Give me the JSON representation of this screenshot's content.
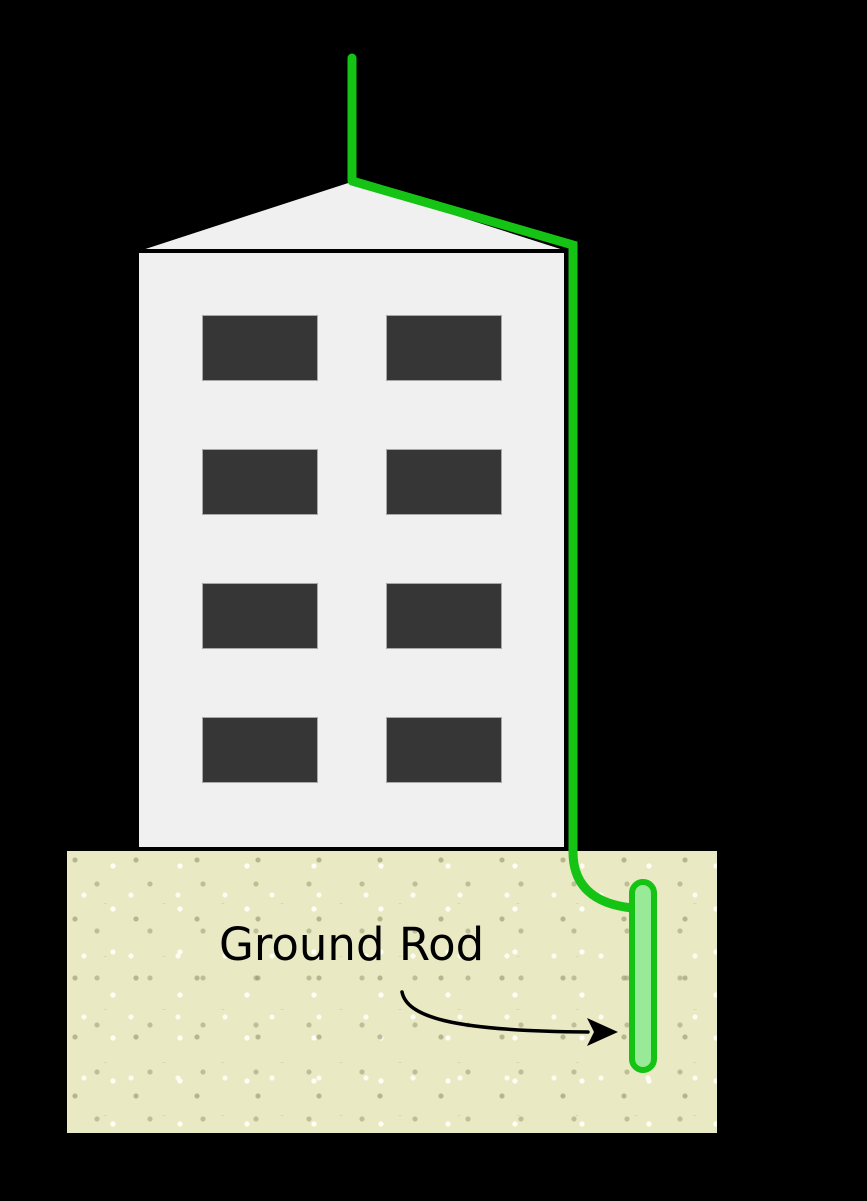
{
  "diagram": {
    "type": "lightning-protection-grounding-diagram",
    "labels": {
      "ground_rod": "Ground Rod"
    },
    "elements": {
      "building_window_rows": 4,
      "building_window_cols": 2
    }
  },
  "colors": {
    "background": "#000000",
    "building_fill": "#f0f0f0",
    "building_outline": "#000000",
    "window_fill": "#363636",
    "window_outline": "#a8a8a8",
    "wire_green": "#14c314",
    "rod_fill": "#98e998",
    "ground_fill": "#e9e9c4",
    "ground_speckle_dark": "#949468",
    "ground_speckle_light": "#fffff8",
    "annotation": "#000000"
  }
}
